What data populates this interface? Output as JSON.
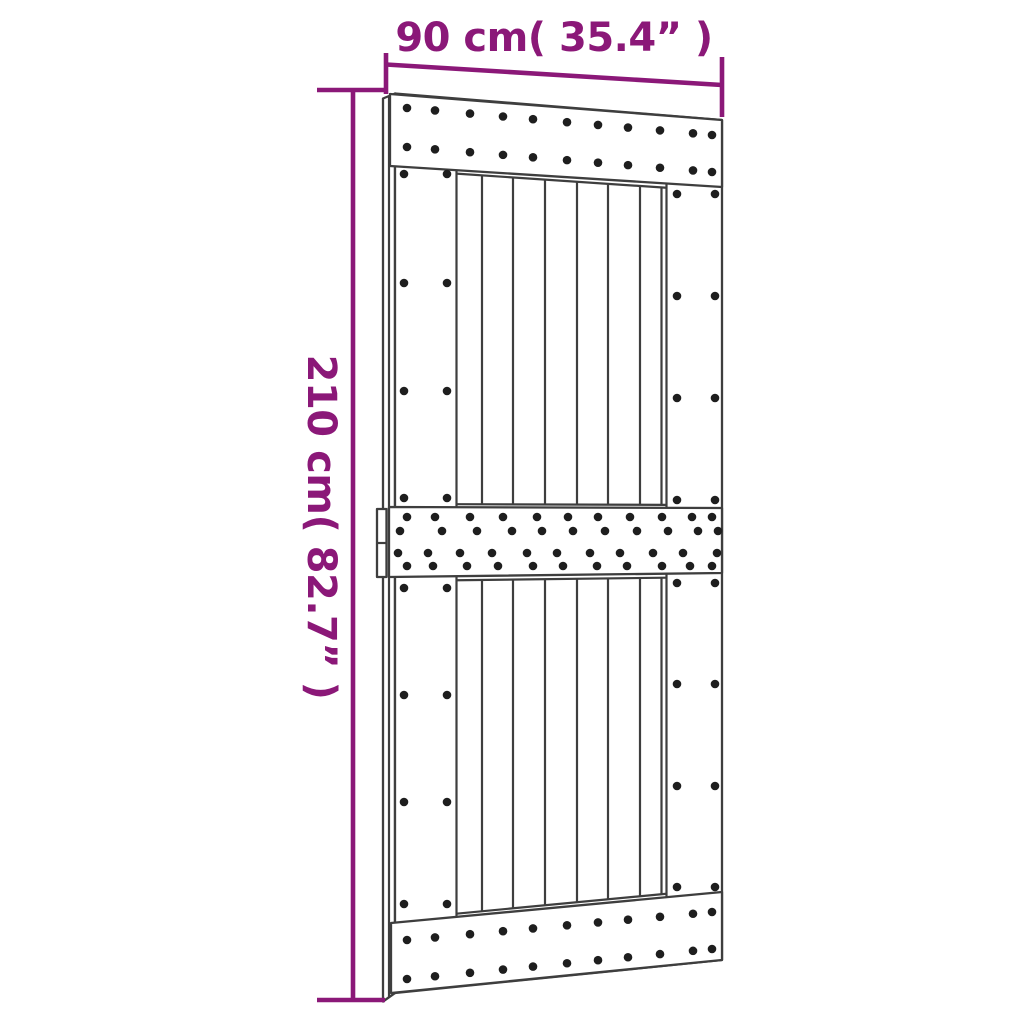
{
  "page": {
    "background_color": "#ffffff"
  },
  "diagram": {
    "kind": "product-dimension-diagram",
    "subject": "sliding barn door, front view with nailed rails and vertical planks",
    "accent_color": "#8b1878",
    "line_color": "#3e3e3e",
    "dot_color": "#1e1e1e",
    "width_dimension": {
      "label": "90 cm( 35.4” )",
      "cm": "90",
      "inches": "35.4"
    },
    "height_dimension": {
      "label": "210 cm( 82.7” )",
      "cm": "210",
      "inches": "82.7"
    },
    "door": {
      "rails": [
        "top rail",
        "middle rail",
        "bottom rail"
      ],
      "plank_columns": 8,
      "rail_nail_rows": {
        "top": 2,
        "middle": 4,
        "bottom": 2
      },
      "stile_nail_pairs_per_section": 4,
      "handle": "edge-mounted latch on left side at middle-rail height"
    }
  }
}
